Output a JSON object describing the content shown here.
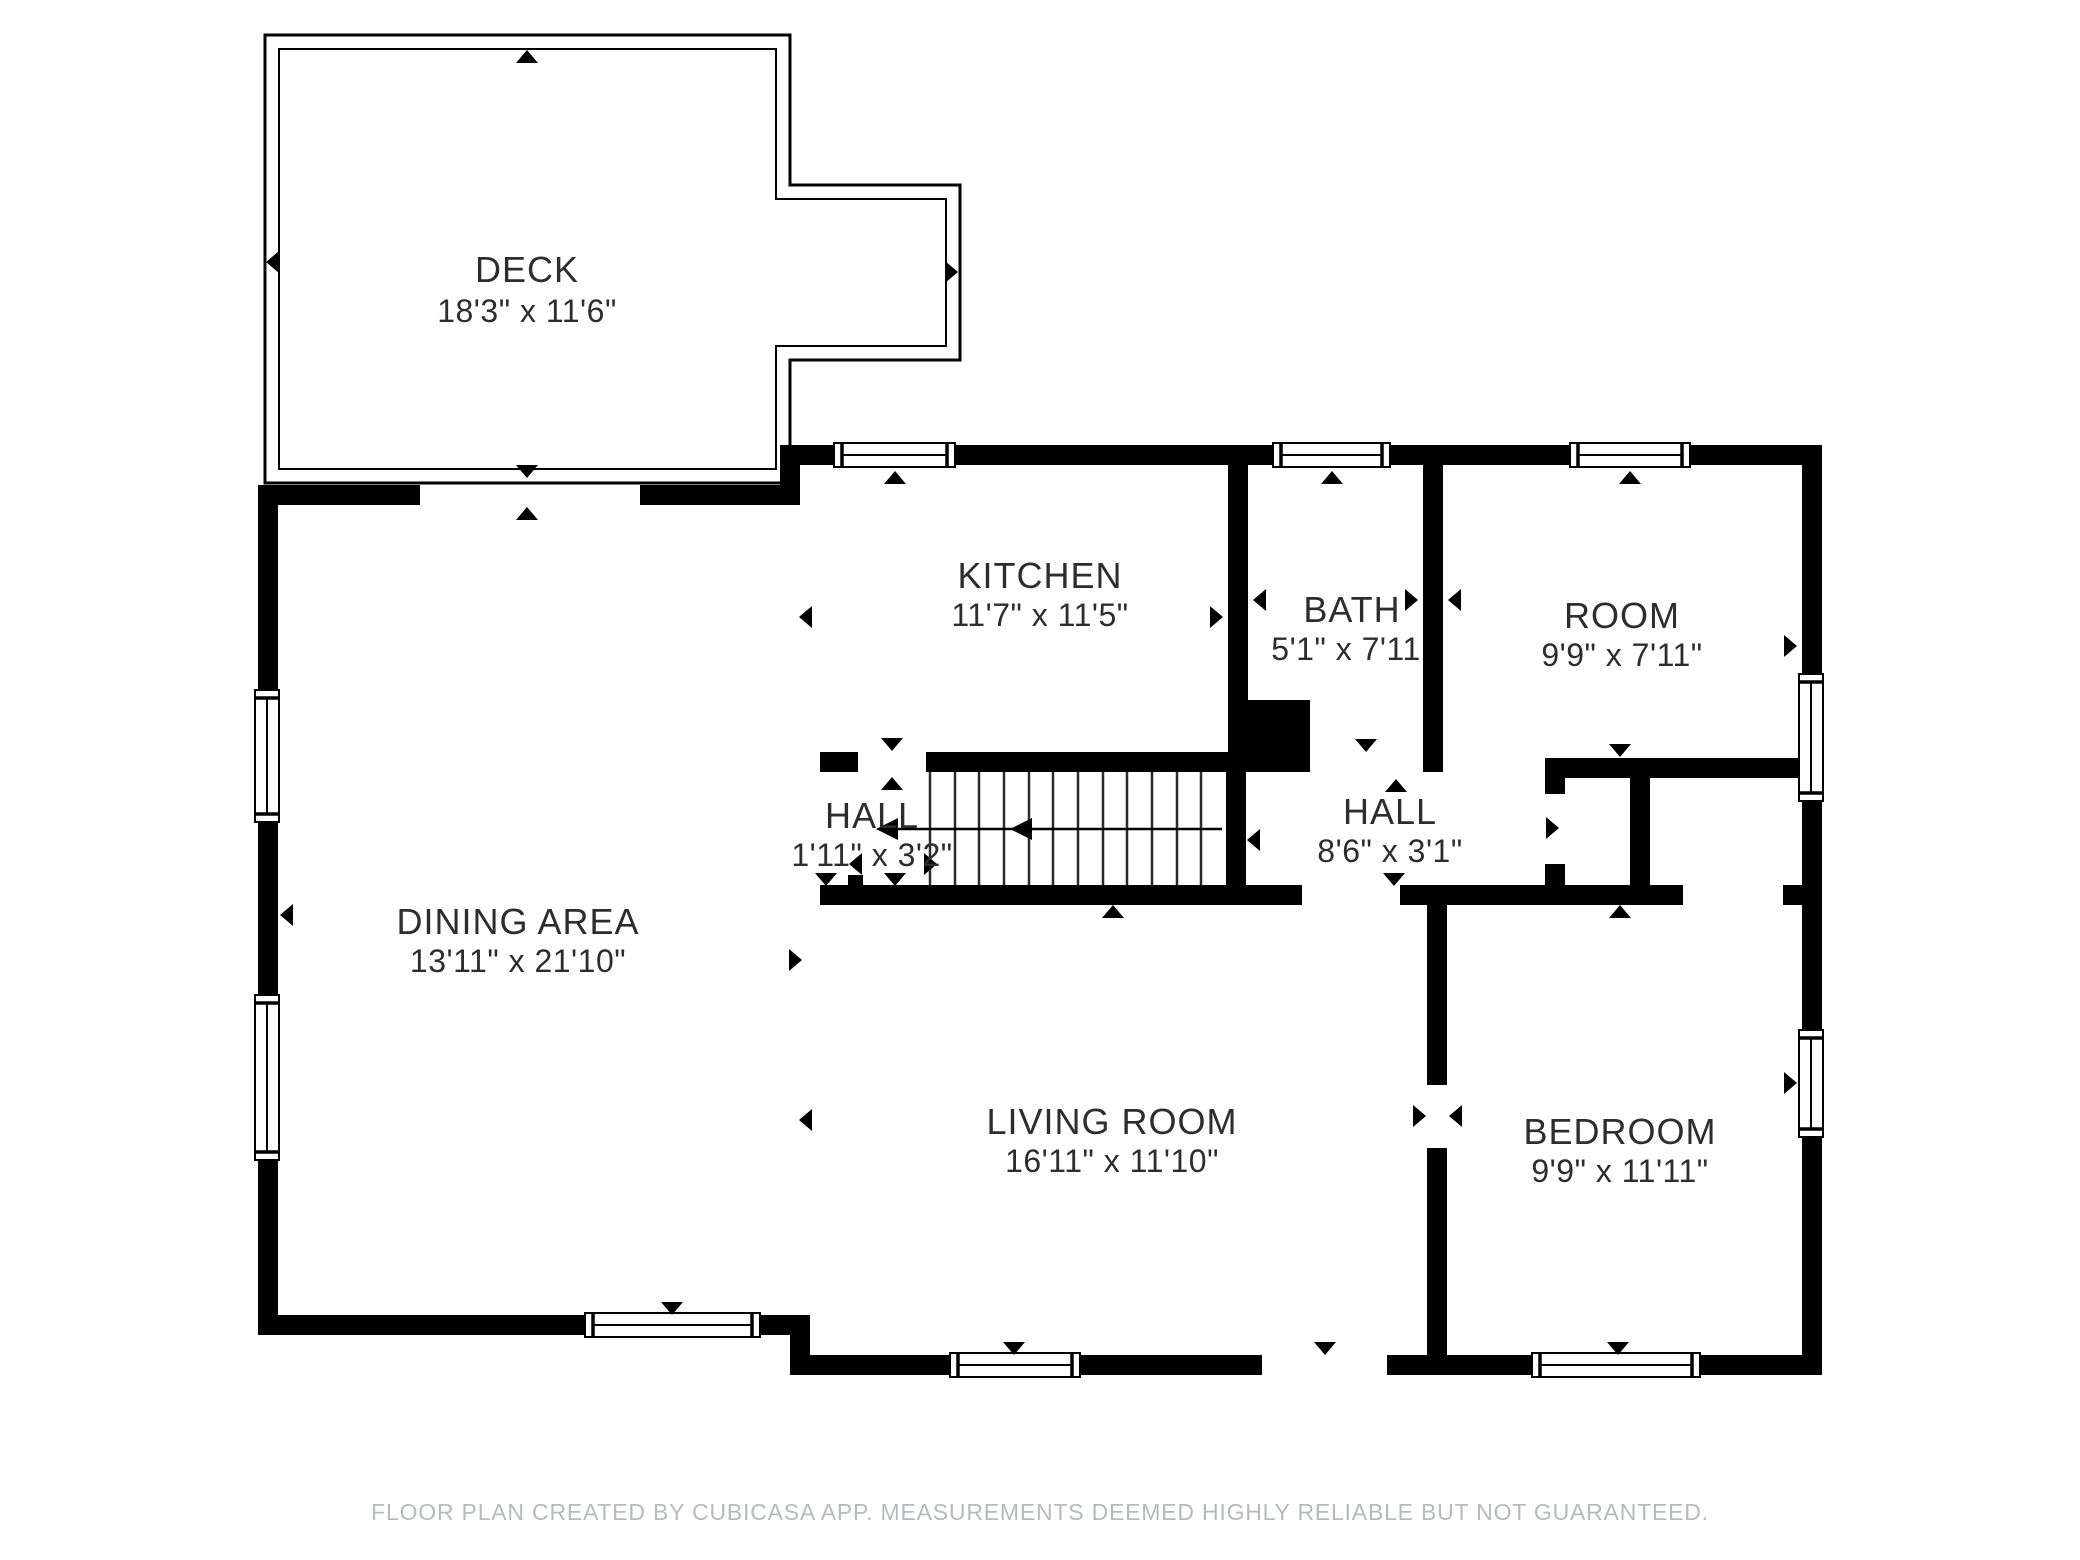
{
  "floor_plan": {
    "rooms": [
      {
        "name": "DECK",
        "dimensions": "18'3\" x 11'6\""
      },
      {
        "name": "KITCHEN",
        "dimensions": "11'7\" x 11'5\""
      },
      {
        "name": "BATH",
        "dimensions": "5'1\" x 7'11"
      },
      {
        "name": "ROOM",
        "dimensions": "9'9\" x 7'11\""
      },
      {
        "name": "HALL",
        "dimensions": "1'11\" x 3'2\""
      },
      {
        "name": "HALL",
        "dimensions": "8'6\" x 3'1\""
      },
      {
        "name": "DINING AREA",
        "dimensions": "13'11\" x 21'10\""
      },
      {
        "name": "LIVING ROOM",
        "dimensions": "16'11\" x 11'10\""
      },
      {
        "name": "BEDROOM",
        "dimensions": "9'9\" x 11'11\""
      }
    ],
    "footer": "FLOOR PLAN CREATED BY CUBICASA APP. MEASUREMENTS DEEMED HIGHLY RELIABLE BUT NOT GUARANTEED.",
    "colors": {
      "walls": "#000000",
      "background": "#ffffff",
      "label_text": "#2d2d2d",
      "footer_text": "#b7babc"
    }
  }
}
